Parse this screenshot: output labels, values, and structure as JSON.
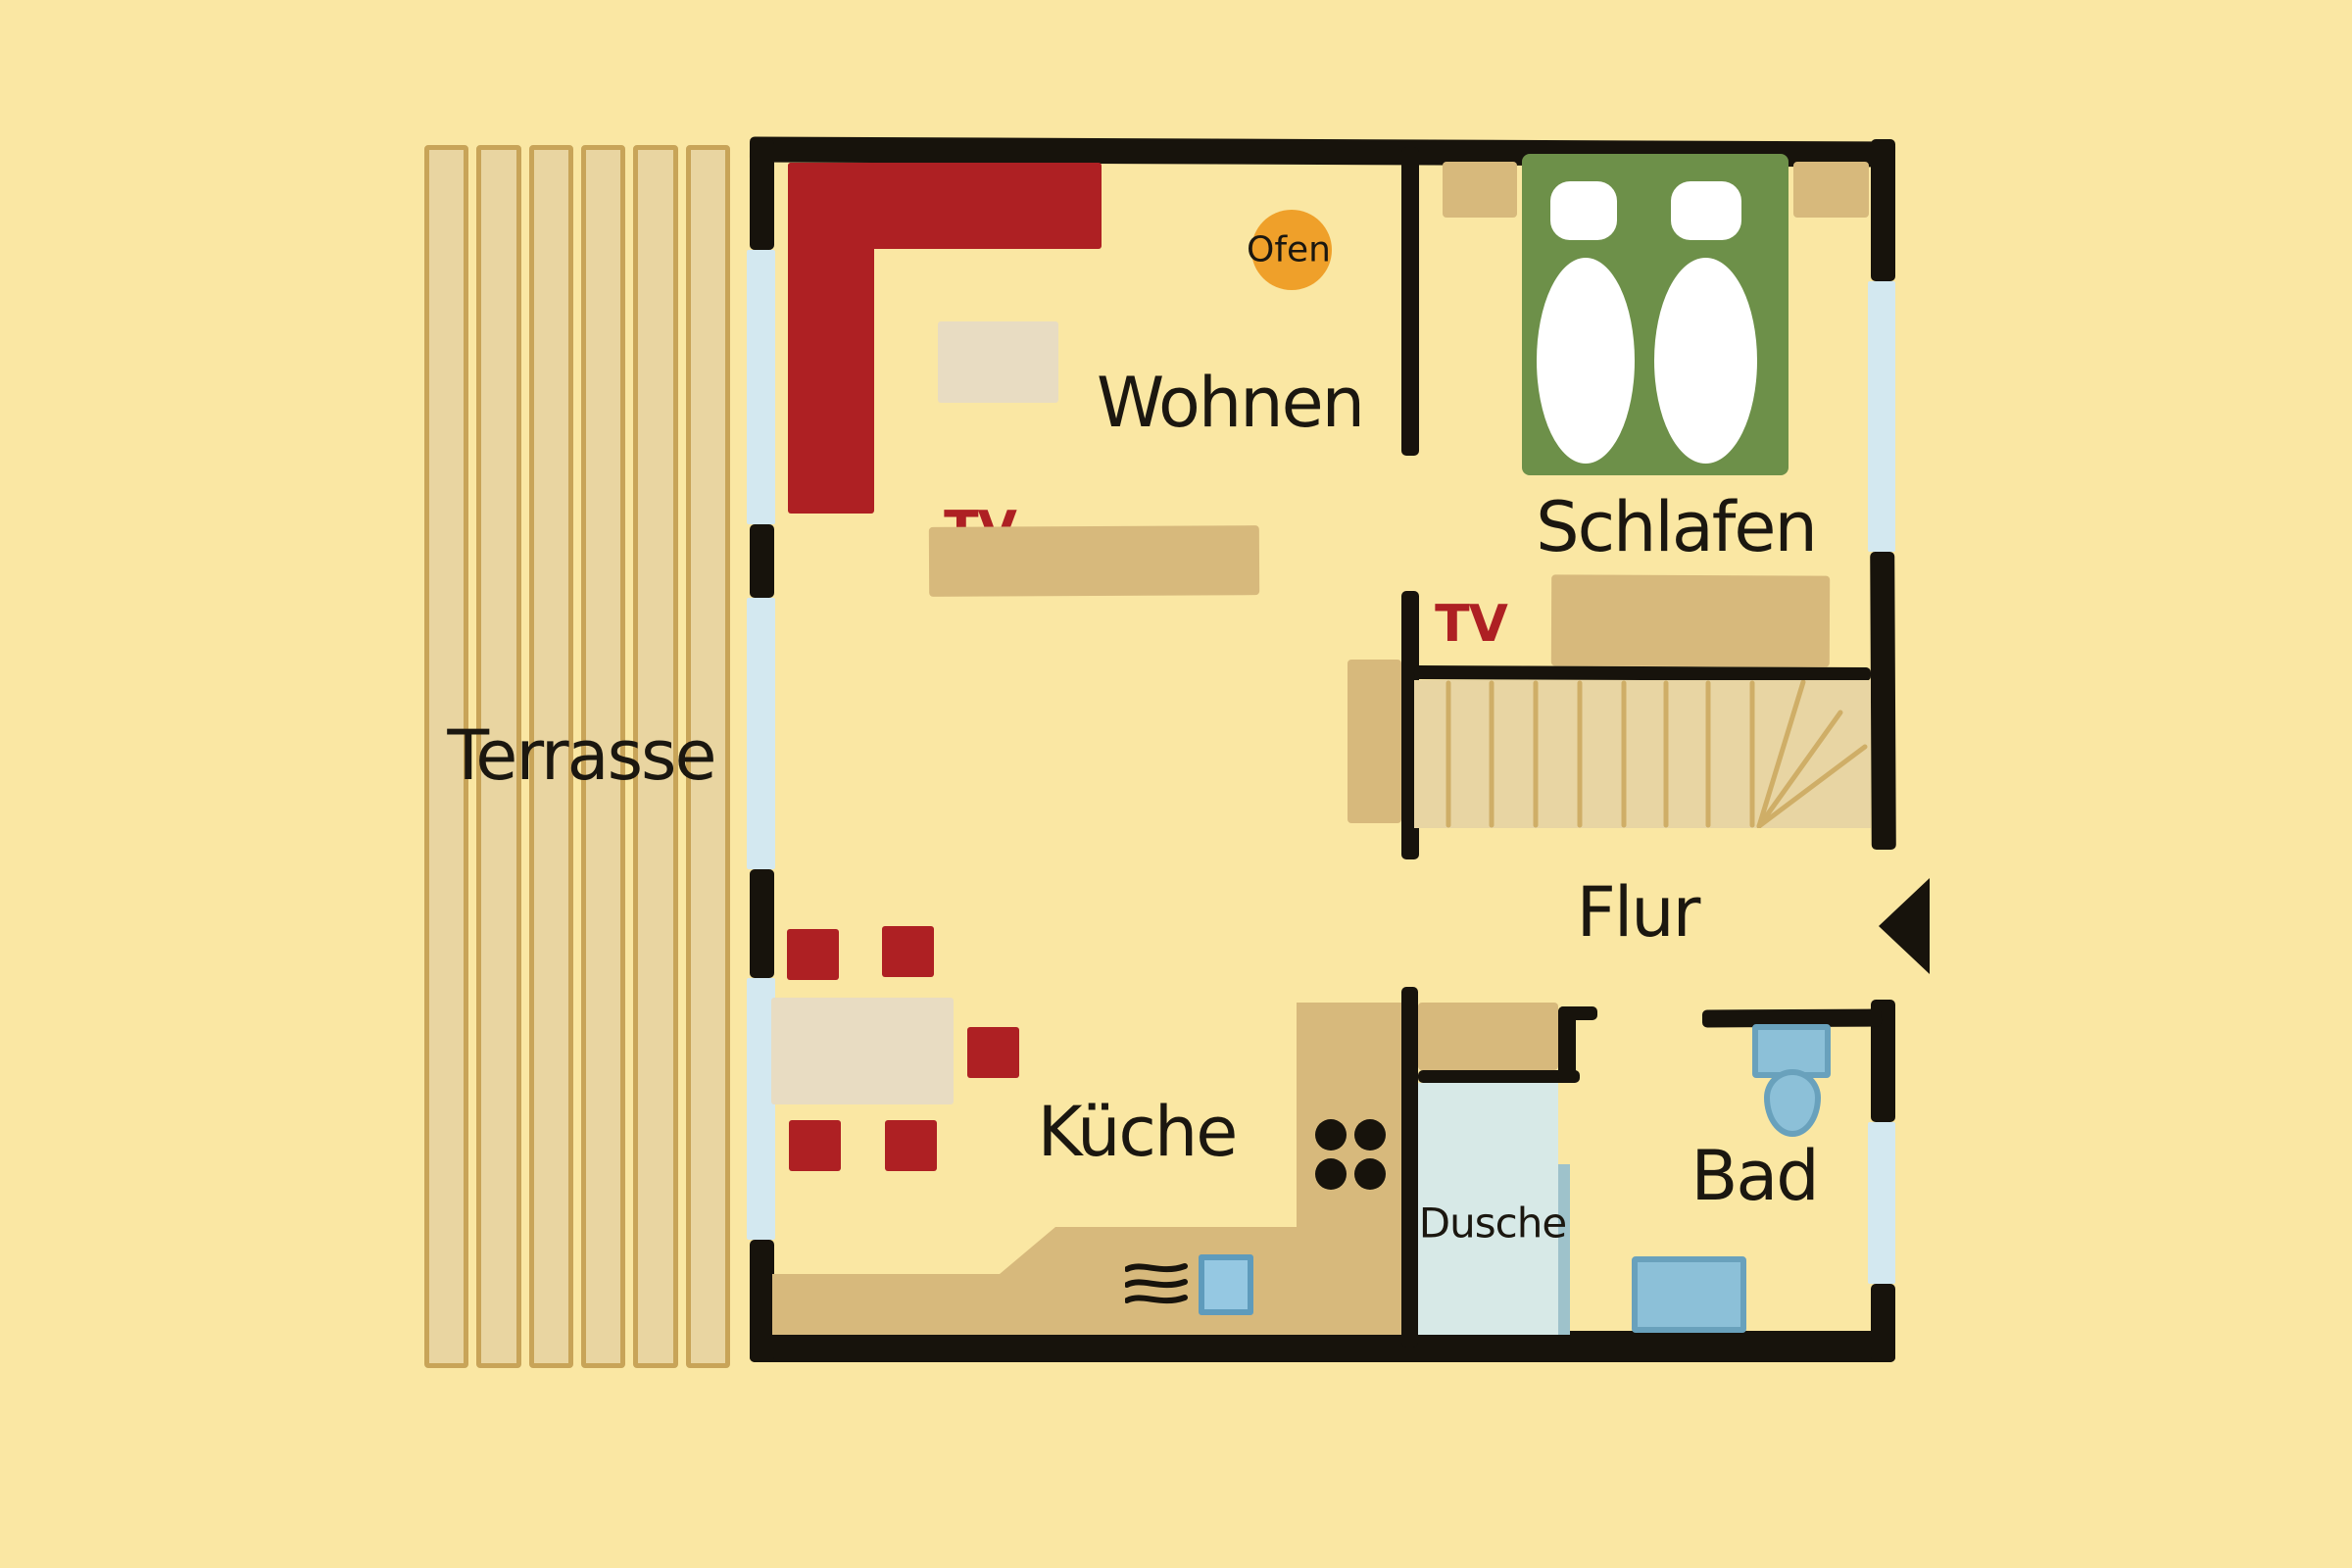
{
  "page": {
    "type": "hand-drawn apartment floor plan",
    "language": "de"
  },
  "rooms": {
    "terrasse": {
      "label": "Terrasse"
    },
    "wohnen": {
      "label": "Wohnen"
    },
    "schlafen": {
      "label": "Schlafen"
    },
    "flur": {
      "label": "Flur"
    },
    "kueche": {
      "label": "Küche"
    },
    "bad": {
      "label": "Bad"
    },
    "dusche": {
      "label": "Dusche"
    }
  },
  "annotations": {
    "ofen": {
      "label": "Ofen"
    },
    "tv_wohnen": {
      "label": "TV"
    },
    "tv_schlafen": {
      "label": "TV"
    }
  },
  "icons": {
    "entrance_arrow": "left-pointing-triangle",
    "stove_hob": "four-black-dots",
    "steam": "three-wavy-lines"
  },
  "colors": {
    "background": "#fae7a3",
    "wall_black": "#17130c",
    "text_black": "#1b1710",
    "accent_red": "#ae2023",
    "wood_tan": "#d7b97c",
    "plank_fill": "#e9d5a1",
    "plank_outline": "#c8a458",
    "stairs_fill": "#e8d5a3",
    "stairs_line": "#cfae67",
    "rug_beige": "#e8dcc2",
    "bed_green": "#6d9049",
    "window_blue": "#d3e8f0",
    "shower_blue": "#d7e9e7",
    "glass_blue": "#9ec2cb",
    "fixture_blue": "#8cc0d8",
    "fixture_border": "#69a1bc",
    "sink_blue": "#95c8e2",
    "sink_border": "#5e9bbc",
    "oven_orange": "#efa02a",
    "white": "#ffffff"
  }
}
